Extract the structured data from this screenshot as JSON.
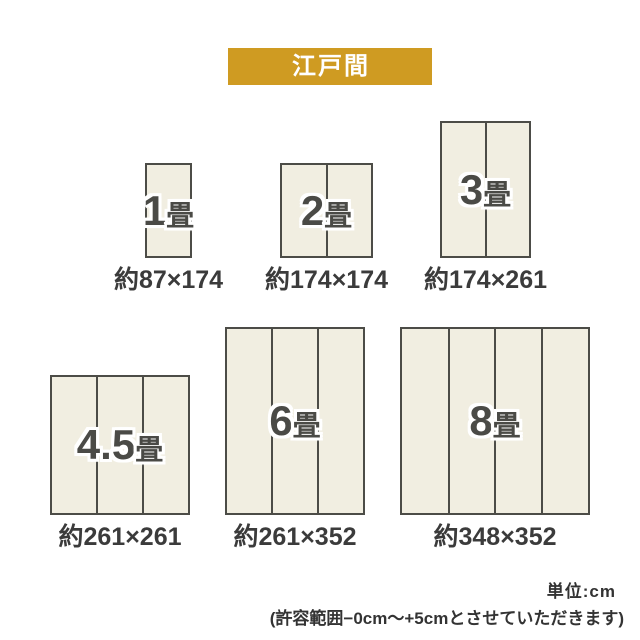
{
  "header": {
    "label": "江戸間",
    "badge_bg": "#cf9b22",
    "badge_text_color": "#ffffff"
  },
  "sizes": [
    {
      "id": "1jo",
      "number": "1",
      "unit": "畳",
      "dimensions": "約87×174",
      "mat_columns": 1,
      "box": {
        "x": 145,
        "y": 163,
        "w": 47,
        "h": 95
      }
    },
    {
      "id": "2jo",
      "number": "2",
      "unit": "畳",
      "dimensions": "約174×174",
      "mat_columns": 2,
      "box": {
        "x": 280,
        "y": 163,
        "w": 93,
        "h": 95
      }
    },
    {
      "id": "3jo",
      "number": "3",
      "unit": "畳",
      "dimensions": "約174×261",
      "mat_columns": 2,
      "box": {
        "x": 440,
        "y": 121,
        "w": 91,
        "h": 137
      }
    },
    {
      "id": "4-5jo",
      "number": "4.5",
      "unit": "畳",
      "dimensions": "約261×261",
      "mat_columns": 3,
      "box": {
        "x": 50,
        "y": 375,
        "w": 140,
        "h": 140
      }
    },
    {
      "id": "6jo",
      "number": "6",
      "unit": "畳",
      "dimensions": "約261×352",
      "mat_columns": 3,
      "box": {
        "x": 225,
        "y": 327,
        "w": 140,
        "h": 188
      }
    },
    {
      "id": "8jo",
      "number": "8",
      "unit": "畳",
      "dimensions": "約348×352",
      "mat_columns": 4,
      "box": {
        "x": 400,
        "y": 327,
        "w": 190,
        "h": 188
      }
    }
  ],
  "footer": {
    "unit_label": "単位:cm",
    "tolerance_note": "(許容範囲−0cm〜+5cmとさせていただきます)"
  },
  "colors": {
    "mat_fill": "#f1eee1",
    "mat_border": "#4c4c47",
    "mat_label_text": "#4a4a46",
    "dimension_text": "#3b3b3b",
    "footer_text": "#333333"
  }
}
